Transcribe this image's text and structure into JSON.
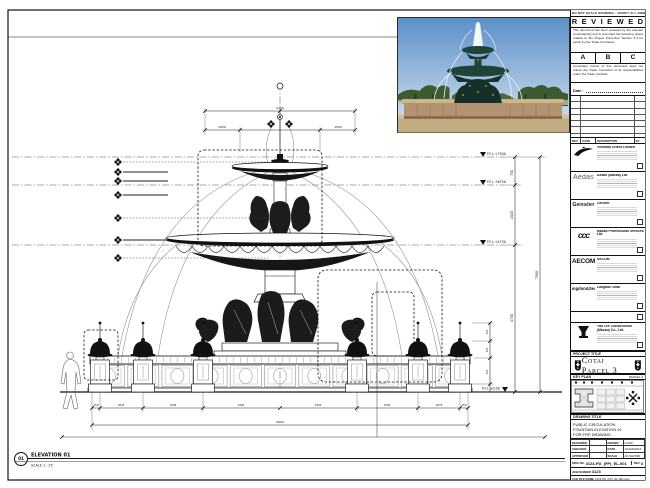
{
  "colors": {
    "paper": "#ffffff",
    "ink": "#111111",
    "photo_sky_top": "#5b8fc9",
    "photo_sky_bottom": "#d9e6f2",
    "photo_tree": "#3d5a31",
    "photo_bronze": "#1d4437",
    "photo_stone": "#b29270",
    "photo_gold": "#c9a23f"
  },
  "sheet": {
    "top_note": "DO NOT SCALE DRAWING · VERIFY ALL DIMENSIONS ON SITE · REPORT ALL DISCREPANCIES"
  },
  "stamp": {
    "title": "R E V I E W E D",
    "para1": "This document has been reviewed by the relevant Consultant(s) and is accorded the following status relative to the Project Procedure Section 5.4 for action by the Trade Contractor.",
    "grades": [
      "A",
      "B",
      "C"
    ],
    "para2": "Consultant review of this document does not relieve the Trade Contractor of its responsibilities under the Trade Contract.",
    "date_label": "Date :"
  },
  "revision_header": {
    "rev": "REV",
    "date": "DATE",
    "description": "DESCRIPTION",
    "by": "BY"
  },
  "consultants": [
    {
      "logo_icon": "venetian-wing-icon",
      "name": "Venetian Orient Limited"
    },
    {
      "logo_label": "Aedas",
      "name": "Aedas (Macau) Ltd."
    },
    {
      "logo_label": "Gensler",
      "name": "Gensler"
    },
    {
      "logo_label": "ccc",
      "name": "Macau Professional Services Ltd."
    },
    {
      "logo_label": "AECOM",
      "name": "AECOM"
    },
    {
      "logo_label": "Langdon&Seah",
      "name": "Langdon Seah"
    }
  ],
  "contractor": {
    "name": "Yau Lee Construction (Macau) Co., Ltd."
  },
  "project": {
    "label": "PROJECT TITLE",
    "title": "Cotai Parcel 3"
  },
  "key_plan": {
    "label": "KEY PLAN",
    "note": "PARCEL 3"
  },
  "drawing_title": {
    "label": "DRAWING TITLE",
    "line1": "PUBLIC CIRCULATION",
    "line2": "FOUNTAIN ELEVATION 01",
    "line3": "FOR FRP DRAWING"
  },
  "info": {
    "designed_label": "DESIGNED",
    "designed": "-",
    "drawn_label": "DRAWN",
    "drawn": "CHAD",
    "checked_label": "CHECKED",
    "checked": "-",
    "date_label": "DATE",
    "date": "12/JAN/2016",
    "approved_label": "APPROVED",
    "approved": "-",
    "scale_label": "SCALE",
    "scale": "AS SHOWN"
  },
  "numbers": {
    "dwg_no_label": "DWG NO.",
    "dwg_no": "3123-PD_(FP)_EL-001",
    "rev_label": "REV",
    "rev": "0",
    "job_label": "JOB NUMBER",
    "job": "3123",
    "cad_label": "CAD FILE NAME",
    "cad": "3123-PD_(FP)_EL-001.dwg",
    "ref_label": "REFERENCE DWG FILE NAME"
  },
  "drawing": {
    "elevation_bubble": "01",
    "elevation_label": "ELEVATION 01",
    "scale_note": "SCALE 1 : 25",
    "levels": [
      "F.F.L +7500",
      "F.F.L +6750",
      "F.F.L +4730",
      "F.F.L ±0.00"
    ],
    "vertical_dims": [
      "750",
      "2020",
      "4730",
      "7500"
    ],
    "top_total": "2100",
    "top_segments": [
      "1050",
      "1050"
    ],
    "bottom_segments": [
      "450",
      "1075",
      "1500",
      "1925",
      "1925",
      "1500",
      "1075",
      "450"
    ],
    "bottom_total": "9900",
    "post_dims": [
      "450",
      "300",
      "450"
    ]
  }
}
